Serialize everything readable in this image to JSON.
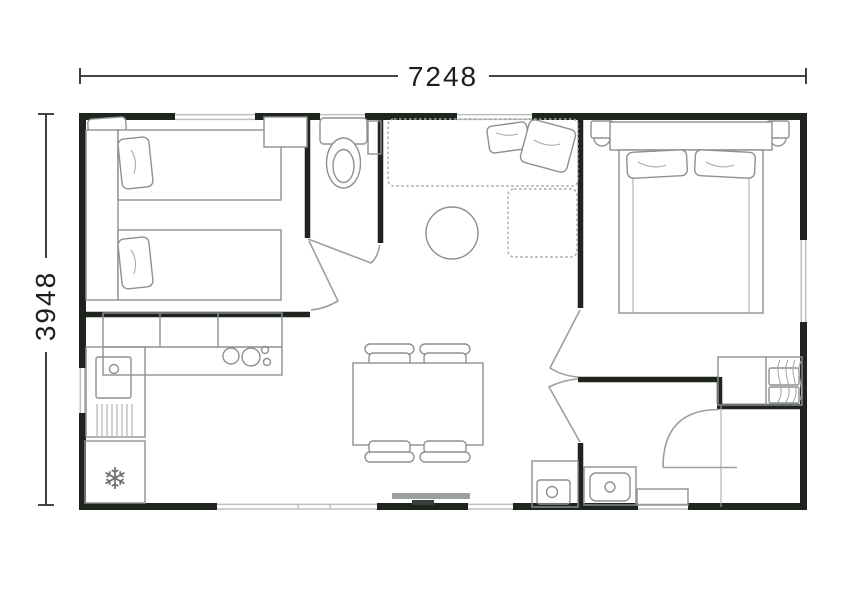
{
  "dimensions": {
    "width_label": "7248",
    "height_label": "3948"
  },
  "icons": {
    "fridge_snowflake": "❄"
  },
  "colors": {
    "background": "#ffffff",
    "wall": "#20241f",
    "furniture_line": "#8d918f",
    "dimension_text": "#1c1e1c",
    "dimension_line": "#2a2d2a"
  },
  "plan": {
    "rooms": [
      {
        "id": "bedroom-1",
        "furniture": [
          "twin-bed",
          "twin-bed",
          "headboard",
          "pillows",
          "wardrobe"
        ]
      },
      {
        "id": "wc",
        "furniture": [
          "toilet",
          "shelf"
        ]
      },
      {
        "id": "living-room",
        "furniture": [
          "sofa",
          "chaise",
          "cushions",
          "round-coffee-table"
        ]
      },
      {
        "id": "kitchen",
        "furniture": [
          "worktop-cabinets",
          "hob",
          "sink",
          "drainer",
          "fridge"
        ]
      },
      {
        "id": "dining-area",
        "furniture": [
          "table",
          "chair",
          "chair",
          "chair",
          "chair"
        ]
      },
      {
        "id": "bedroom-2",
        "furniture": [
          "double-bed",
          "nightstand",
          "nightstand",
          "wardrobe"
        ]
      },
      {
        "id": "shower-room",
        "furniture": [
          "washbasin",
          "water-heater",
          "window-sill",
          "door"
        ]
      }
    ],
    "openings": [
      "windows",
      "doors",
      "sliding-patio-door"
    ]
  }
}
